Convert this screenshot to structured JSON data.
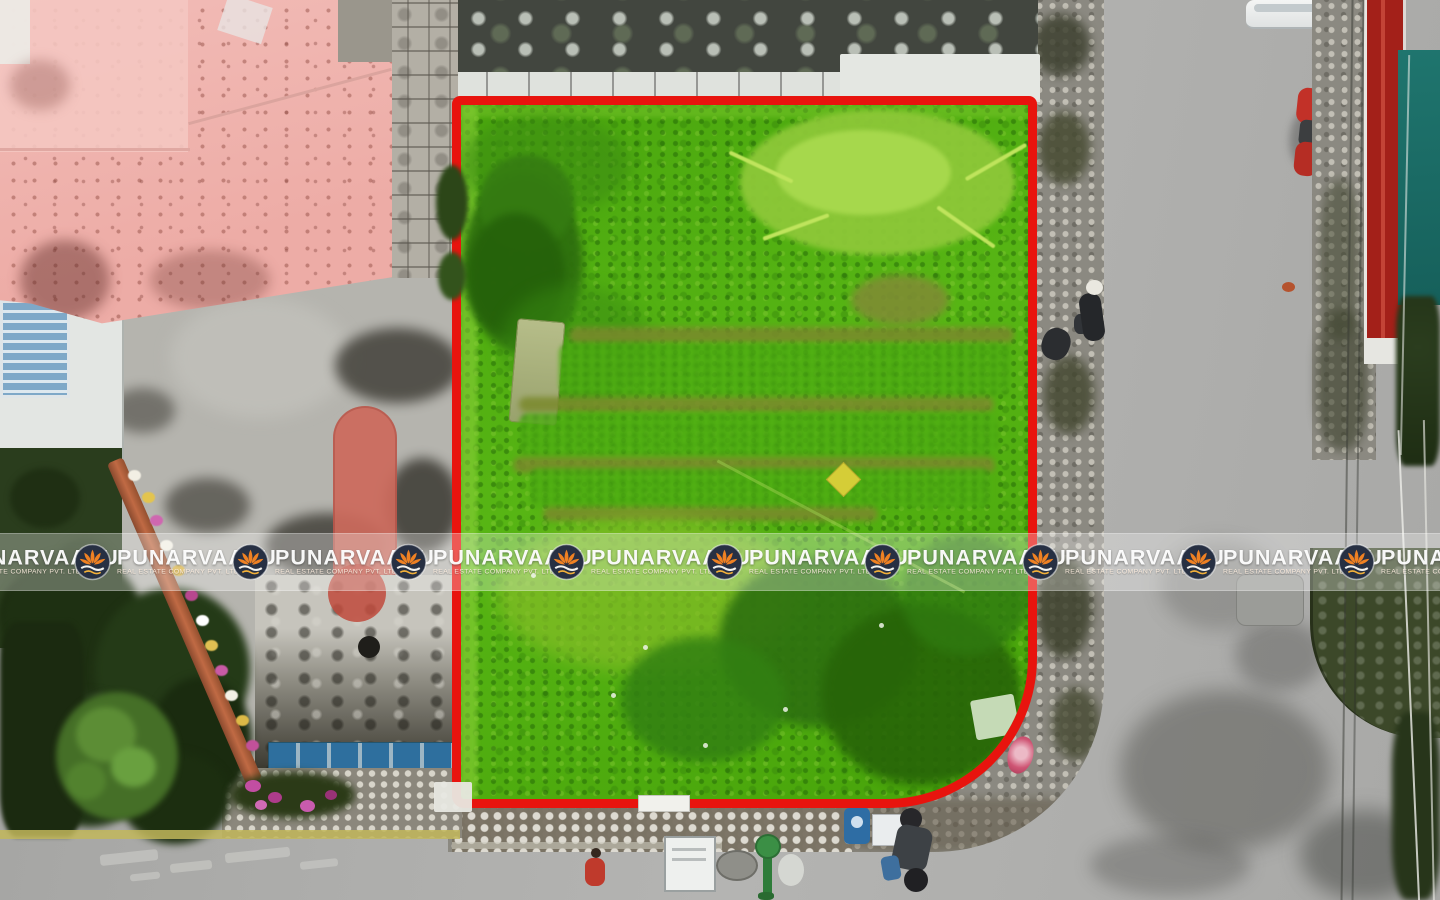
{
  "image_type": "aerial drone photograph",
  "scene": {
    "subject": "Vacant land plot for sale, highlighted green and outlined with a red boundary",
    "plot": {
      "boundary_color": "#e8140e",
      "highlight_color": "#4fae10",
      "shape": "rectangular with rounded bottom-right corner"
    },
    "surroundings": [
      "pink-roofed house top left",
      "concrete courtyard with red oval marking on left",
      "white building with blue louvered roof section",
      "garden trees and flower hedge bottom left",
      "cobblestone sidewalks surrounding the plot",
      "asphalt road on right and bottom",
      "long red rooftop and teal rooftop on right edge",
      "white car top right",
      "red motorcycle parked on right sidewalk",
      "pedestrians, dark motorcycle and street objects on bottom road"
    ]
  },
  "watermark": {
    "brand": "PUNARVAASU",
    "tagline": "REAL ESTATE COMPANY PVT. LTD.",
    "logo": "lotus-sunrise-icon",
    "logo_colors": {
      "circle": "#273043",
      "lotus": "#ef8123",
      "wave": "#f2f2f0"
    },
    "text_color": "#ffffff",
    "repeat_count": 10,
    "band_opacity": 0.3
  },
  "palette": {
    "road": "#aaaaa8",
    "pink_roof": "#f0b5b0",
    "dark_neighbour_roof": "#42463f",
    "teal_roof": "#1f756e",
    "red_roof": "#a32019",
    "cobblestone": "#8b8981",
    "concrete": "#b5b4ae",
    "vegetation_dark": "#223618",
    "red_oval_marking": "#cd6a5c"
  }
}
